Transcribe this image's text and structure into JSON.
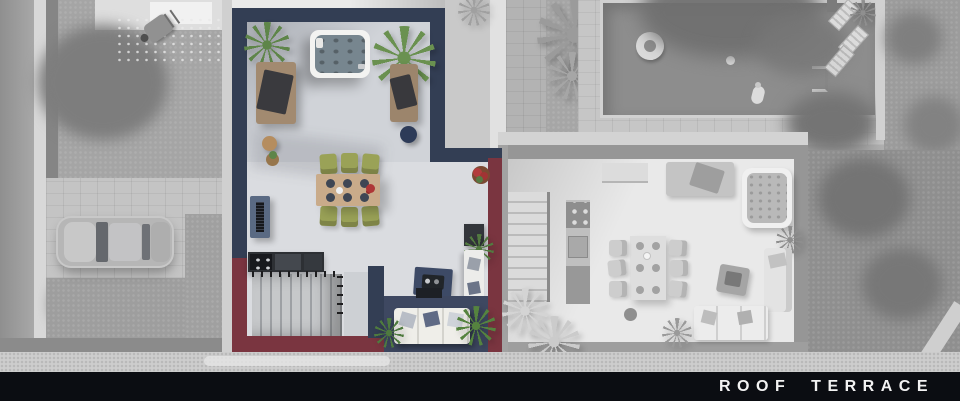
{
  "caption": {
    "title": "ROOF TERRACE"
  },
  "colors": {
    "navy_wall": "#333e54",
    "maroon_wall": "#7a3540",
    "floor_light": "#dadce0",
    "floor_shaded": "#d0d3d8",
    "olive_chair": "#9aa257",
    "table_wood": "#c9ab8a",
    "hot_tub_water": "#77868f",
    "plant_green": "#5e8549",
    "sofa_white": "#efeee9",
    "rug_navy": "#3d4a66",
    "lounge_floor_navy": "#3e4861",
    "kitchen_dark": "#2d3034",
    "daybed_tan": "#a28a70",
    "flower_red": "#ae3636",
    "bar_black": "#0b0d12",
    "text_white": "#f2f2f2",
    "gray_lawn": "#a5a5a5",
    "gray_paving": "#c6c6c6",
    "gray_pool": "#8d8d8d",
    "gray_interior": "#e9e9e9",
    "gray_wall": "#969696",
    "sidewalk": "#cdcdcd"
  },
  "scene": {
    "kind": "3d-floor-plan-top-down-render",
    "floor_label": "ROOF TERRACE",
    "highlight": "left duplex unit rendered in colour; mirrored twin unit and all surroundings desaturated grey",
    "left_unit_objects": [
      "hot-tub",
      "palm-plant",
      "palm-plant",
      "sun-daybed-left",
      "sun-daybed-right",
      "navy-pouf",
      "round-side-table",
      "plant-basket",
      "console-bench",
      "dining-table-for-six",
      "olive-green-chairs",
      "plates-setting",
      "red-table-flowers",
      "outdoor-kitchen-counter",
      "staircase-with-railing",
      "navy-rug-with-tray",
      "white-lounge-sofa",
      "tv-panel",
      "potted-red-flowers",
      "white-sideboard",
      "green-plants"
    ],
    "context_objects": [
      "swimming-pool",
      "swim-ring-float",
      "pool-ball",
      "person-at-pool-edge",
      "pool-ladder",
      "sun-loungers",
      "pool-side-trees",
      "parked-sports-car",
      "paved-driveway",
      "lawn",
      "garden-trees",
      "wheelbarrow",
      "garage-roof",
      "street",
      "mirrored-twin-unit-grey",
      "twin-unit-hot-tub",
      "twin-unit-dining-set",
      "twin-unit-kitchen",
      "twin-unit-stairs",
      "twin-unit-sofas",
      "sidewalk"
    ]
  }
}
